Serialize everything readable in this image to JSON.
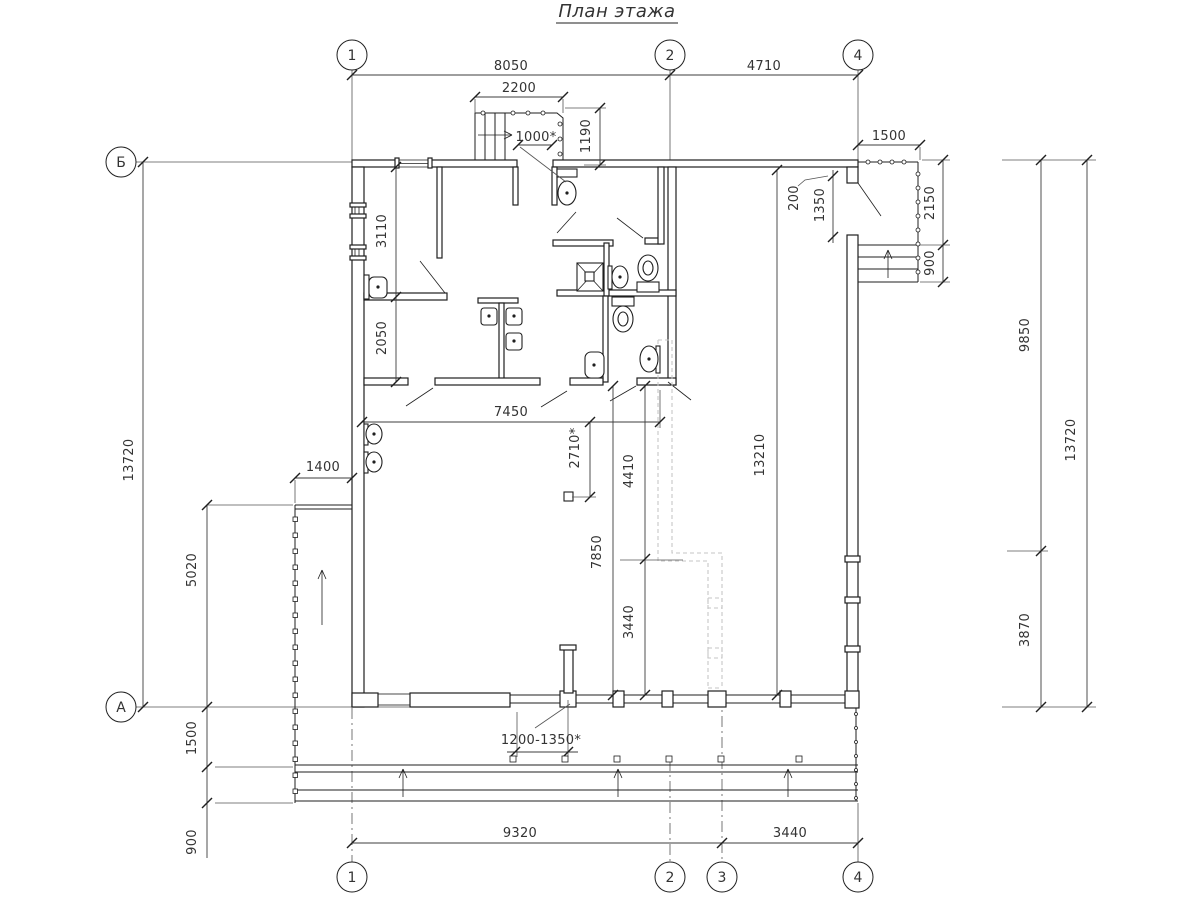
{
  "title": "План этажа",
  "grid_axes": {
    "top": [
      "1",
      "2",
      "4"
    ],
    "bottom": [
      "1",
      "2",
      "3",
      "4"
    ],
    "left": [
      "Б",
      "А"
    ]
  },
  "dims": {
    "d8050": "8050",
    "d2200": "2200",
    "d4710": "4710",
    "d1000": "1000*",
    "d1190": "1190",
    "d1500_top": "1500",
    "d200": "200",
    "d1350": "1350",
    "d2150": "2150",
    "d900_right": "900",
    "d3110": "3110",
    "d2050": "2050",
    "d7450": "7450",
    "d2710": "2710*",
    "d7850": "7850",
    "d4410": "4410",
    "d3440_mid": "3440",
    "d13210": "13210",
    "d13720_left": "13720",
    "d5020": "5020",
    "d1400": "1400",
    "d1500_left": "1500",
    "d900_left": "900",
    "d9320": "9320",
    "d3440_bottom": "3440",
    "d1200_1350": "1200-1350*",
    "d9850": "9850",
    "d3870": "3870",
    "d13720_right": "13720"
  }
}
